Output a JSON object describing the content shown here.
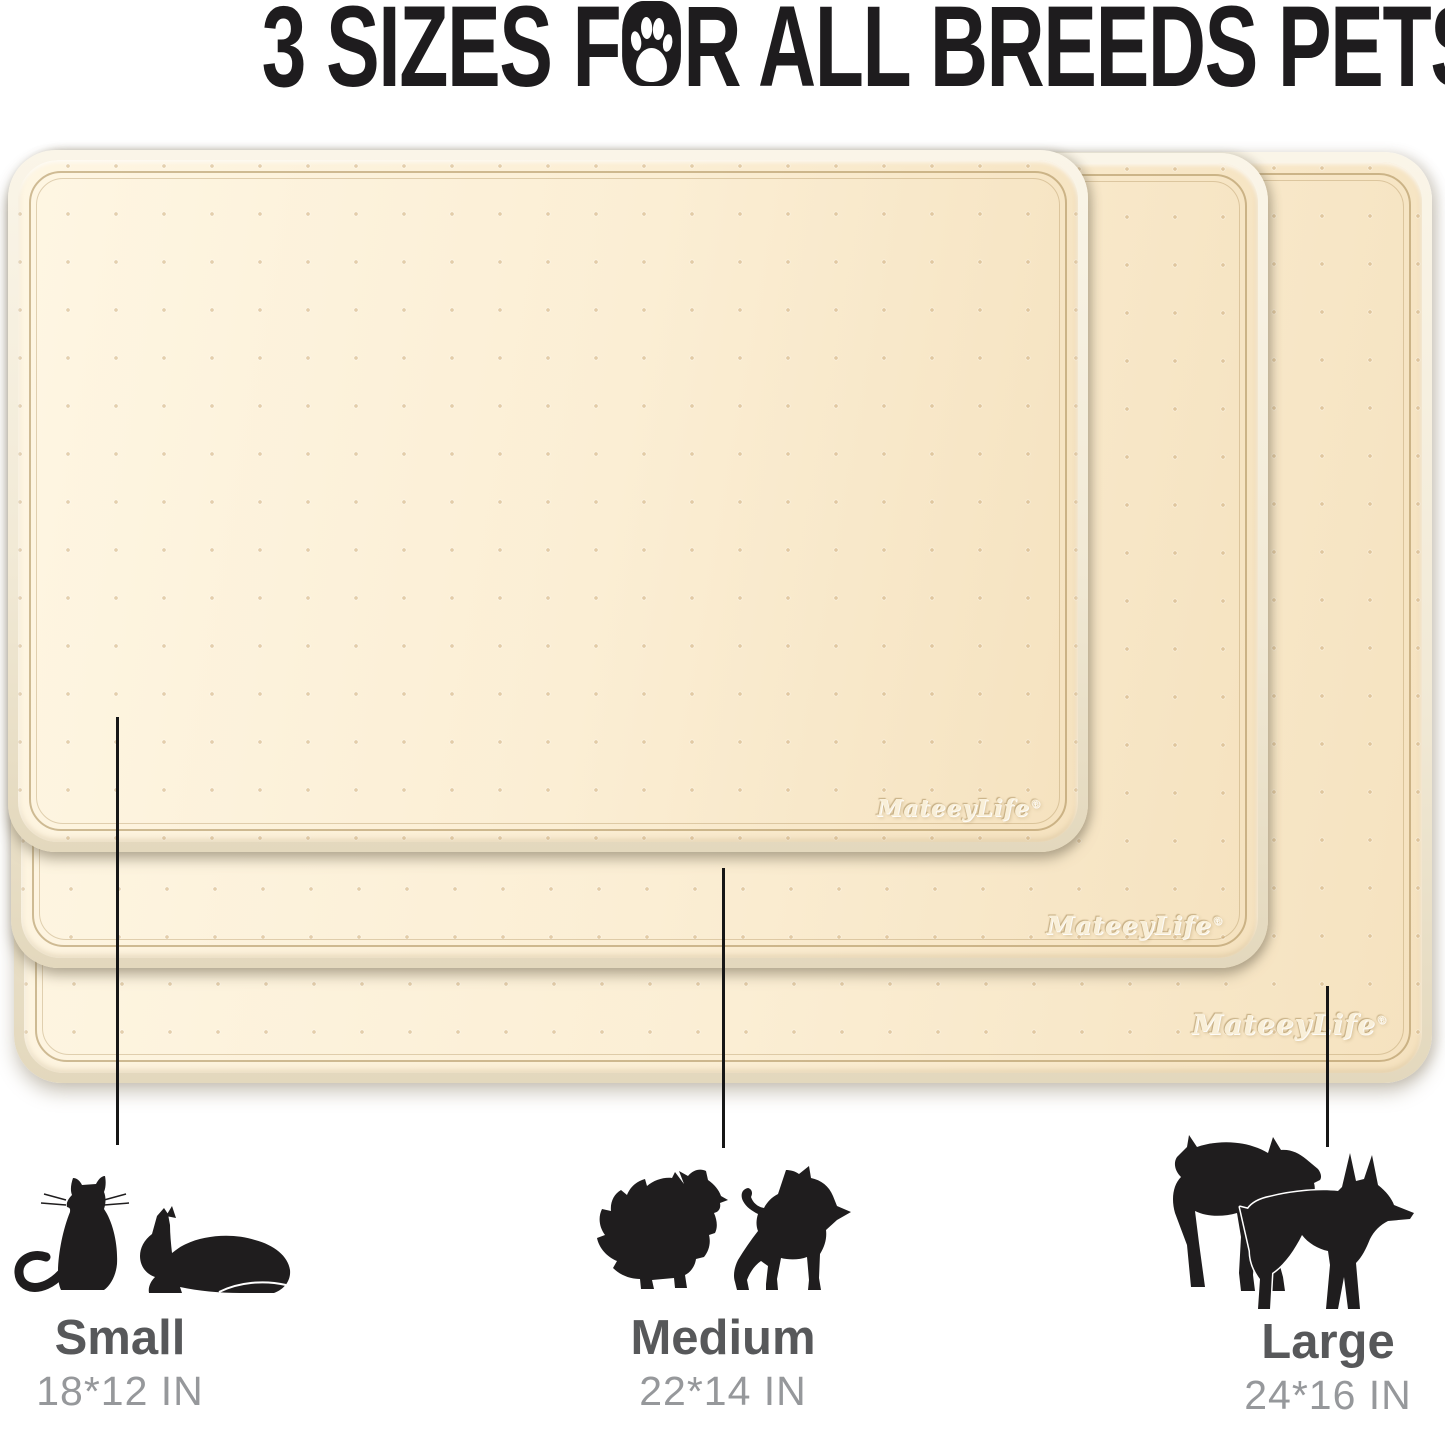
{
  "title": {
    "text_before_paw": "3 SIZES F",
    "text_after_paw": "R ALL BREEDS PETS",
    "full_text": "3 SIZES FOR ALL BREEDS PETS",
    "color": "#1e1c1e"
  },
  "brand": {
    "name": "MateeyLife",
    "registered_mark": "®"
  },
  "mats": {
    "count": 3,
    "surface_color": "#fbeed4",
    "rim_color": "#f1e9d5",
    "border_line_color": "#a88a54",
    "texture": "dot-grid"
  },
  "sizes": [
    {
      "id": "small",
      "label": "Small",
      "dimensions": "18*12 IN",
      "pets": "cats"
    },
    {
      "id": "medium",
      "label": "Medium",
      "dimensions": "22*14 IN",
      "pets": "small dogs"
    },
    {
      "id": "large",
      "label": "Large",
      "dimensions": "24*16 IN",
      "pets": "large dogs"
    }
  ],
  "colors": {
    "label_text": "#57585a",
    "dimension_text": "#96989b",
    "silhouette": "#1f1d1e",
    "connector_line": "#161616",
    "title_text": "#1e1c1e"
  }
}
